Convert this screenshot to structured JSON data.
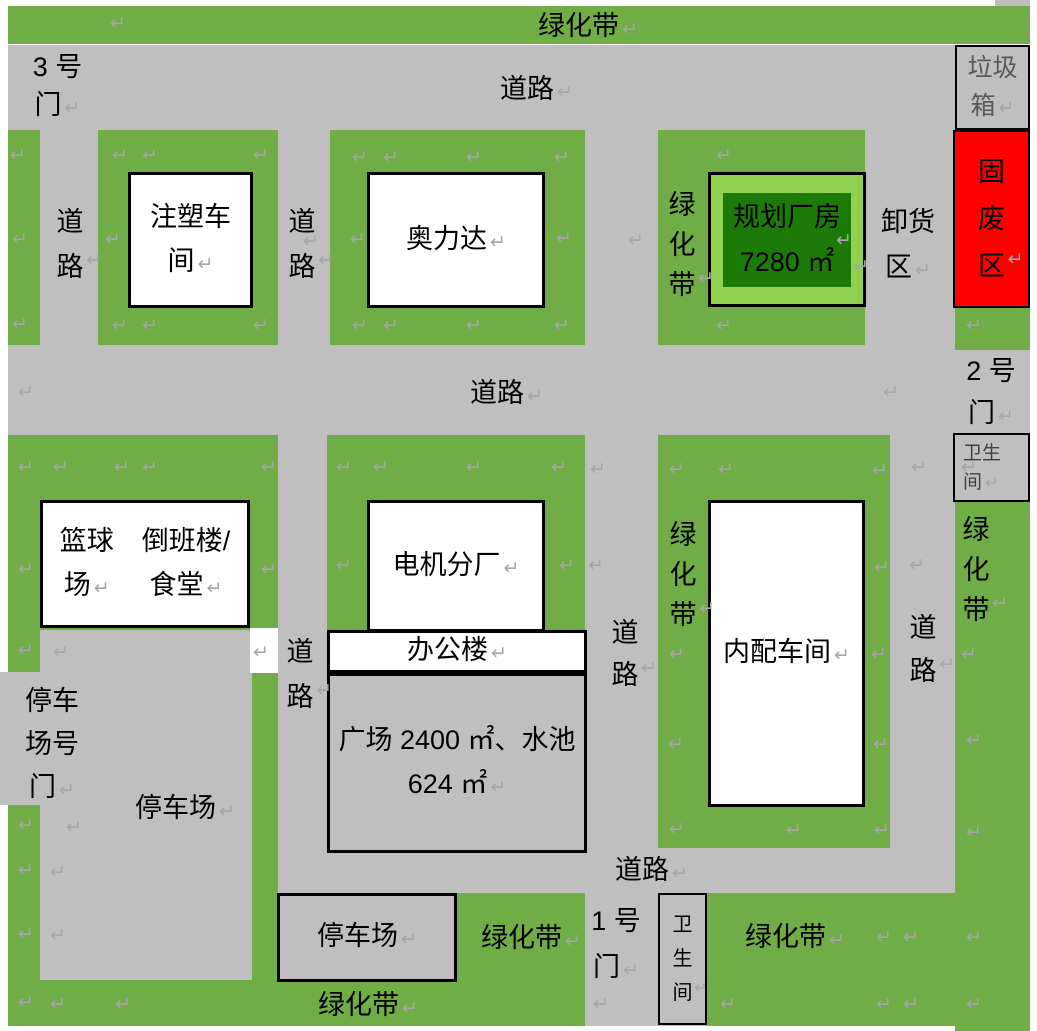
{
  "colors": {
    "green": "#70AD47",
    "lightgreen": "#92D050",
    "dkgreen": "#1B7A08",
    "gray": "#BFBFBF",
    "red": "#FF0000",
    "mark": "#A6A6A6",
    "ink": "#000000",
    "trash-ink": "#595959",
    "restroom-ink": "#3F3F3F"
  },
  "texts": {
    "mark": "↵",
    "green_belt": "绿化带",
    "road": "道路",
    "gate3_line1": "3 号",
    "gate2_line1": "2 号",
    "gate1_line1": "1 号",
    "gate_door": "门",
    "trash_line1": "垃圾",
    "trash_line2": "箱",
    "solid_waste": "固废区",
    "unload_line1": "卸货",
    "unload_line2": "区",
    "restroom_line1": "卫生",
    "restroom_line2": "间",
    "restroom_vertical": "卫生间",
    "molding_line1": "注塑车",
    "molding_line2": "间",
    "aolida": "奥力达",
    "planned_line1": "规划厂房",
    "planned_line2": "7280 ㎡",
    "basketball_line1": "篮球",
    "basketball_line2": "场",
    "dorm_line1": "倒班楼/",
    "dorm_line2": "食堂",
    "motor": "电机分厂",
    "office": "办公楼",
    "plaza_line1": "广场 2400 ㎡、水池",
    "plaza_line2": "624 ㎡",
    "neipei": "内配车间",
    "parking": "停车场",
    "pgate_line1": "停车",
    "pgate_line2": "场号",
    "pgate_line3": "门"
  },
  "marks": [
    [
      110,
      14
    ],
    [
      10,
      146
    ],
    [
      12,
      230
    ],
    [
      12,
      315
    ],
    [
      112,
      146
    ],
    [
      142,
      146
    ],
    [
      253,
      146
    ],
    [
      105,
      230
    ],
    [
      112,
      316
    ],
    [
      142,
      316
    ],
    [
      253,
      316
    ],
    [
      352,
      148
    ],
    [
      383,
      148
    ],
    [
      466,
      148
    ],
    [
      554,
      148
    ],
    [
      350,
      230
    ],
    [
      556,
      229
    ],
    [
      352,
      316
    ],
    [
      383,
      316
    ],
    [
      466,
      316
    ],
    [
      554,
      316
    ],
    [
      303,
      232
    ],
    [
      628,
      231
    ],
    [
      716,
      146
    ],
    [
      716,
      316
    ],
    [
      836,
      231
    ],
    [
      966,
      316
    ],
    [
      18,
      383
    ],
    [
      883,
      383
    ],
    [
      911,
      458
    ],
    [
      909,
      556
    ],
    [
      961,
      458
    ],
    [
      961,
      645
    ],
    [
      966,
      731
    ],
    [
      966,
      823
    ],
    [
      966,
      928
    ],
    [
      966,
      995
    ],
    [
      18,
      458
    ],
    [
      53,
      458
    ],
    [
      114,
      458
    ],
    [
      142,
      458
    ],
    [
      261,
      458
    ],
    [
      18,
      560
    ],
    [
      261,
      560
    ],
    [
      253,
      643
    ],
    [
      336,
      458
    ],
    [
      373,
      458
    ],
    [
      466,
      458
    ],
    [
      551,
      458
    ],
    [
      336,
      556
    ],
    [
      559,
      556
    ],
    [
      590,
      460
    ],
    [
      588,
      556
    ],
    [
      593,
      995
    ],
    [
      669,
      460
    ],
    [
      718,
      460
    ],
    [
      872,
      461
    ],
    [
      874,
      558
    ],
    [
      669,
      645
    ],
    [
      871,
      645
    ],
    [
      668,
      735
    ],
    [
      873,
      735
    ],
    [
      669,
      820
    ],
    [
      786,
      821
    ],
    [
      874,
      821
    ],
    [
      18,
      641
    ],
    [
      53,
      643
    ],
    [
      18,
      816
    ],
    [
      66,
      818
    ],
    [
      18,
      861
    ],
    [
      50,
      863
    ],
    [
      18,
      925
    ],
    [
      50,
      926
    ],
    [
      18,
      993
    ],
    [
      50,
      995
    ],
    [
      115,
      995
    ],
    [
      720,
      995
    ],
    [
      876,
      995
    ],
    [
      903,
      995
    ],
    [
      876,
      928
    ],
    [
      903,
      928
    ]
  ]
}
